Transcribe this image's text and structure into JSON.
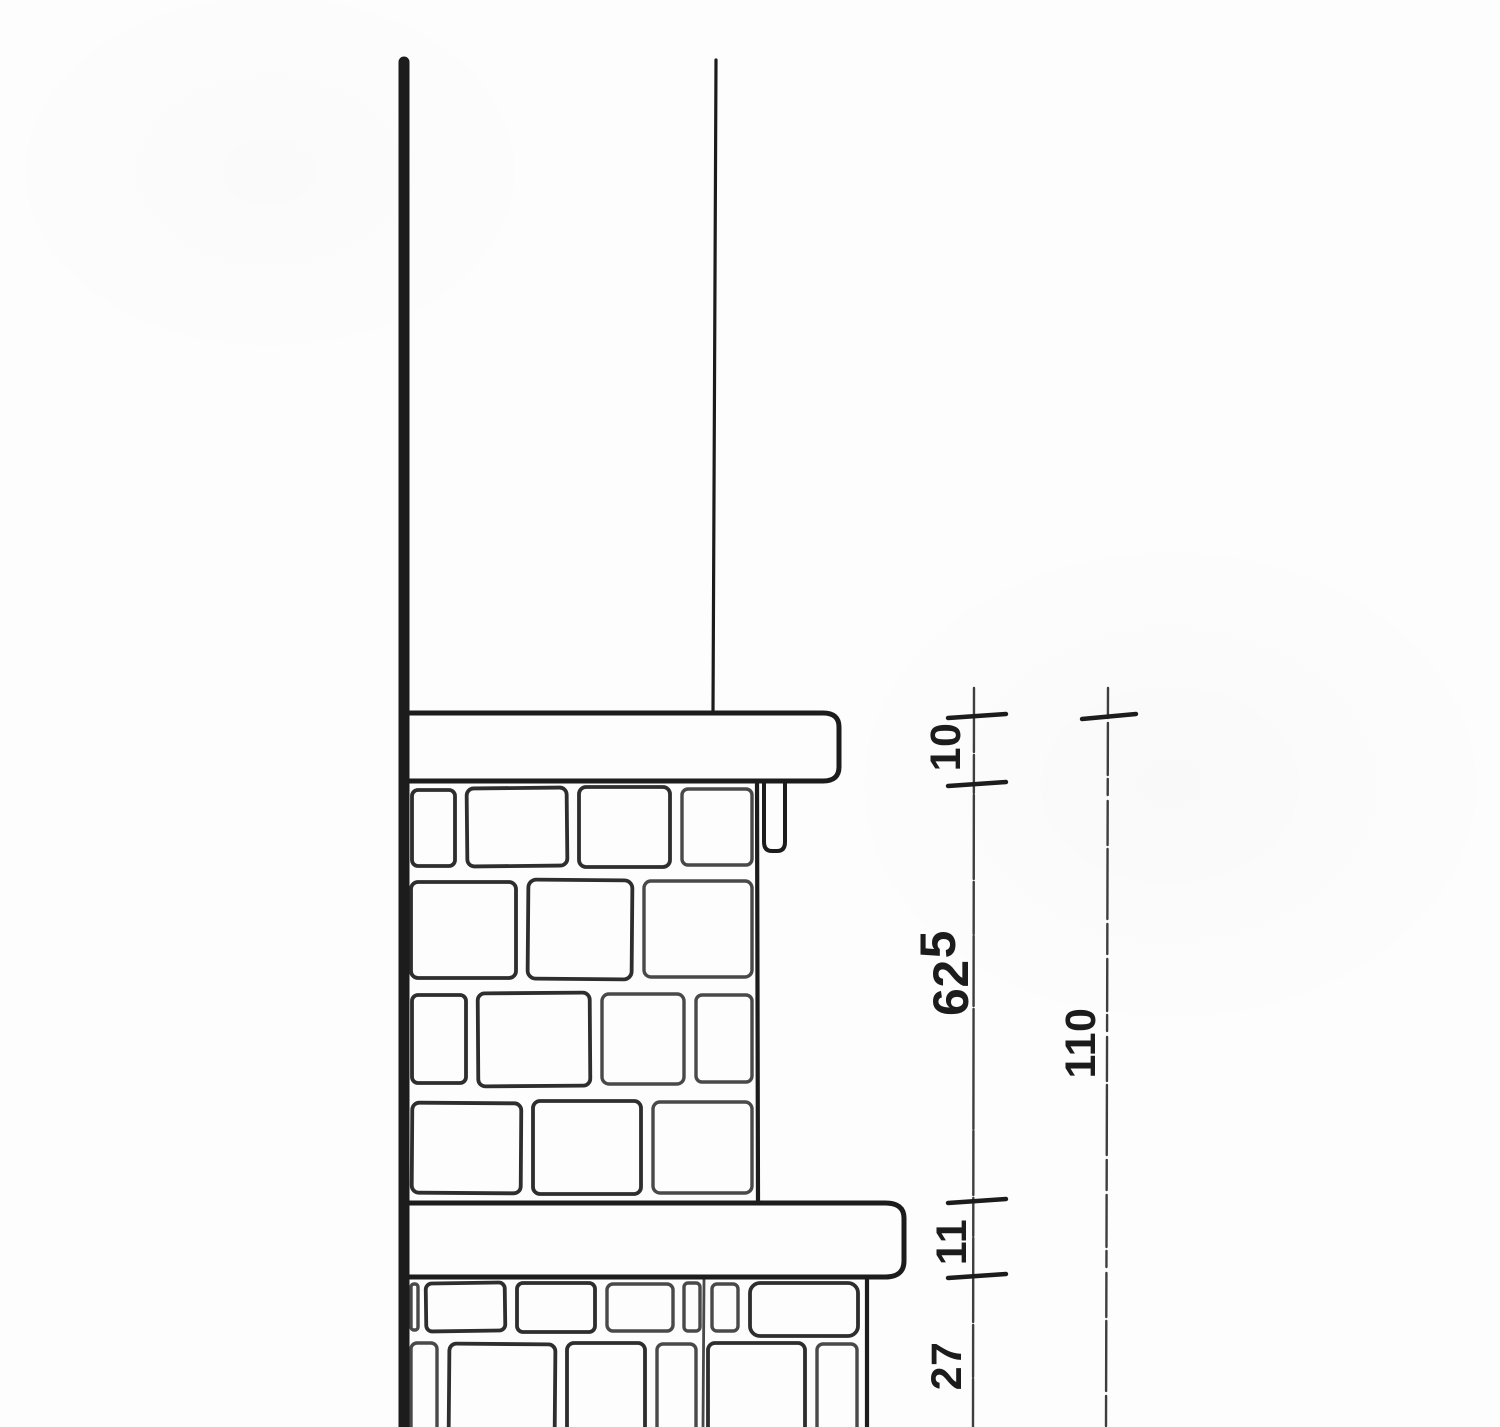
{
  "drawing": {
    "ink_color": "#1c1c1c",
    "paper_color": "#fdfdfd"
  },
  "dims": {
    "d10": "10",
    "d62_main": "62",
    "d62_sup": "5",
    "d11": "11",
    "d27": "27",
    "d110": "110"
  }
}
